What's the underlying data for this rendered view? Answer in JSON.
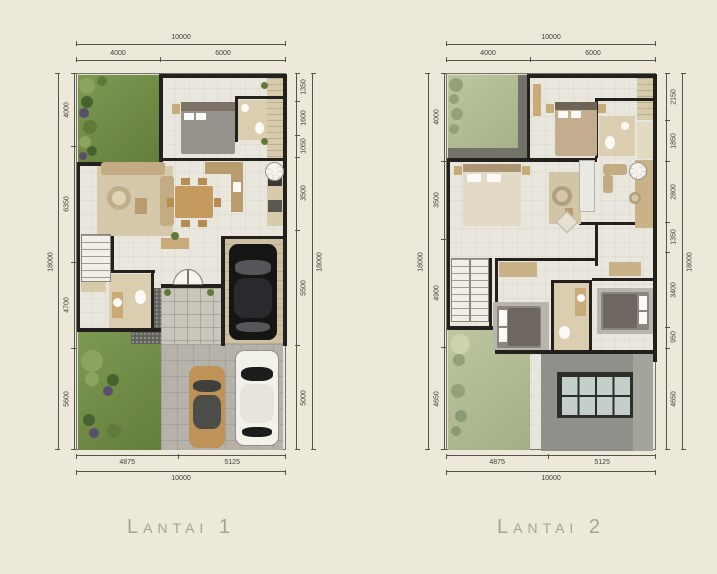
{
  "page": {
    "background": "#ece9db"
  },
  "colors": {
    "wall": "#23211d",
    "grass": "#77934a",
    "grass_faded": "#b6c099",
    "wood": "#c9ab79",
    "driveway": "#b4b2a9",
    "roof": "#8e9089",
    "dimension_line": "#55534a",
    "caption_text": "#a9a293"
  },
  "plans": [
    {
      "caption": "Lantai 1",
      "dims": {
        "top_total": "10000",
        "top_segments": [
          "4000",
          "6000"
        ],
        "left_total": "18000",
        "left_segments": [
          "4000",
          "6350",
          "4700",
          "5600"
        ],
        "right_total": "18000",
        "right_segments": [
          "1350",
          "1600",
          "1050",
          "3500",
          "5500",
          "5000"
        ],
        "bottom_segments": [
          "4875",
          "5125"
        ],
        "bottom_total": "10000"
      }
    },
    {
      "caption": "Lantai 2",
      "dims": {
        "top_total": "10000",
        "top_segments": [
          "4000",
          "6000"
        ],
        "left_total": "18000",
        "left_segments": [
          "4000",
          "3500",
          "4900",
          "4650"
        ],
        "right_total": "18000",
        "right_segments": [
          "2150",
          "1850",
          "2800",
          "1350",
          "3400",
          "950",
          "4650"
        ],
        "bottom_segments": [
          "4875",
          "5125"
        ],
        "bottom_total": "10000"
      }
    }
  ]
}
